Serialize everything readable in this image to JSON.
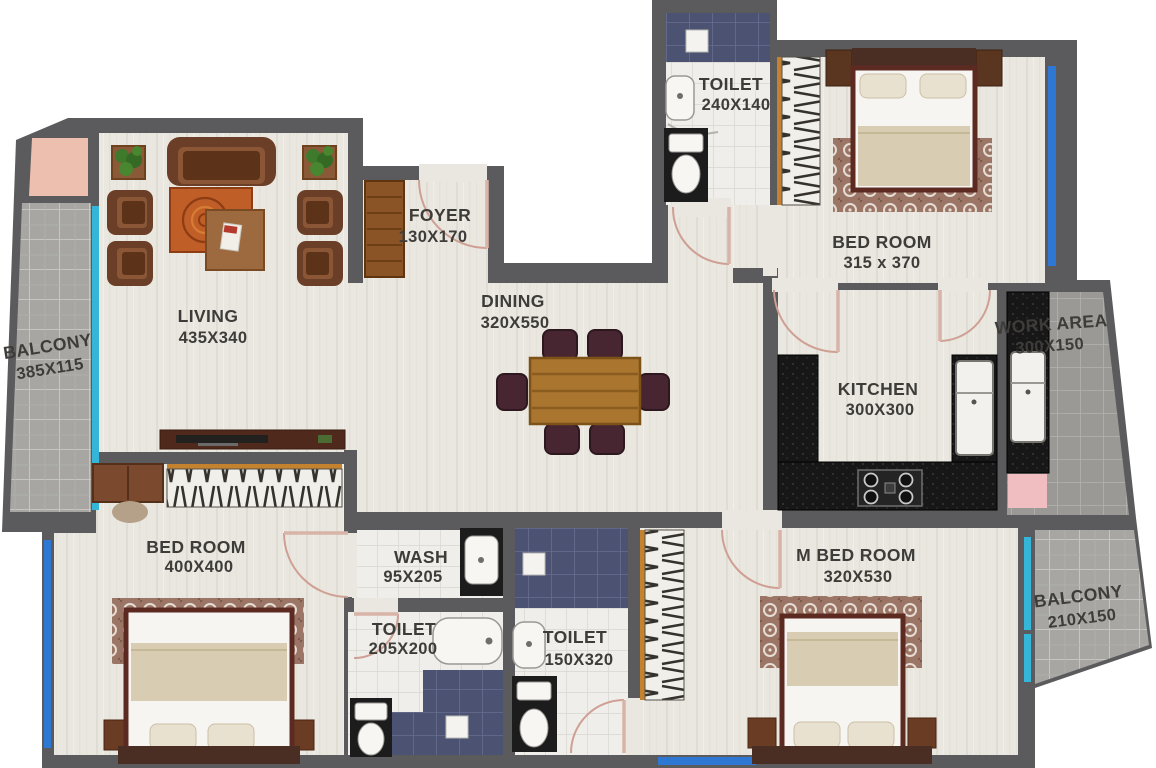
{
  "plan": {
    "type": "apartment-floor-plan",
    "rooms": [
      {
        "id": "balcony-left",
        "name": "BALCONY",
        "dims": "385X115"
      },
      {
        "id": "living",
        "name": "LIVING",
        "dims": "435X340"
      },
      {
        "id": "foyer",
        "name": "FOYER",
        "dims": "130X170"
      },
      {
        "id": "dining",
        "name": "DINING",
        "dims": "320X550"
      },
      {
        "id": "toilet-top",
        "name": "TOILET",
        "dims": "240X140"
      },
      {
        "id": "bedroom-top",
        "name": "BED ROOM",
        "dims": "315 x 370"
      },
      {
        "id": "work-area",
        "name": "WORK AREA",
        "dims": "300X150"
      },
      {
        "id": "kitchen",
        "name": "KITCHEN",
        "dims": "300X300"
      },
      {
        "id": "bedroom-left",
        "name": "BED ROOM",
        "dims": "400X400"
      },
      {
        "id": "wash",
        "name": "WASH",
        "dims": "95X205"
      },
      {
        "id": "toilet-small",
        "name": "TOILET",
        "dims": "205X200"
      },
      {
        "id": "toilet-mid",
        "name": "TOILET",
        "dims": "150X320"
      },
      {
        "id": "m-bedroom",
        "name": "M BED ROOM",
        "dims": "320X530"
      },
      {
        "id": "balcony-right",
        "name": "BALCONY",
        "dims": "210X150"
      }
    ],
    "colors": {
      "wall": "#5b5a5c",
      "floor": "#e9e7df",
      "tile_white": "#efeeea",
      "tile_blue": "#4c5372",
      "balcony_tile": "#a7a6a3",
      "work_tile": "#9a9995",
      "counter_black": "#171717",
      "accent_pink": "#edbfae",
      "window_cyan": "#35b6d9",
      "window_blue": "#2e77d3",
      "door_swing": "#cf9f94",
      "wood_brown": "#7a4b30",
      "label_text": "#3e3c39"
    }
  }
}
